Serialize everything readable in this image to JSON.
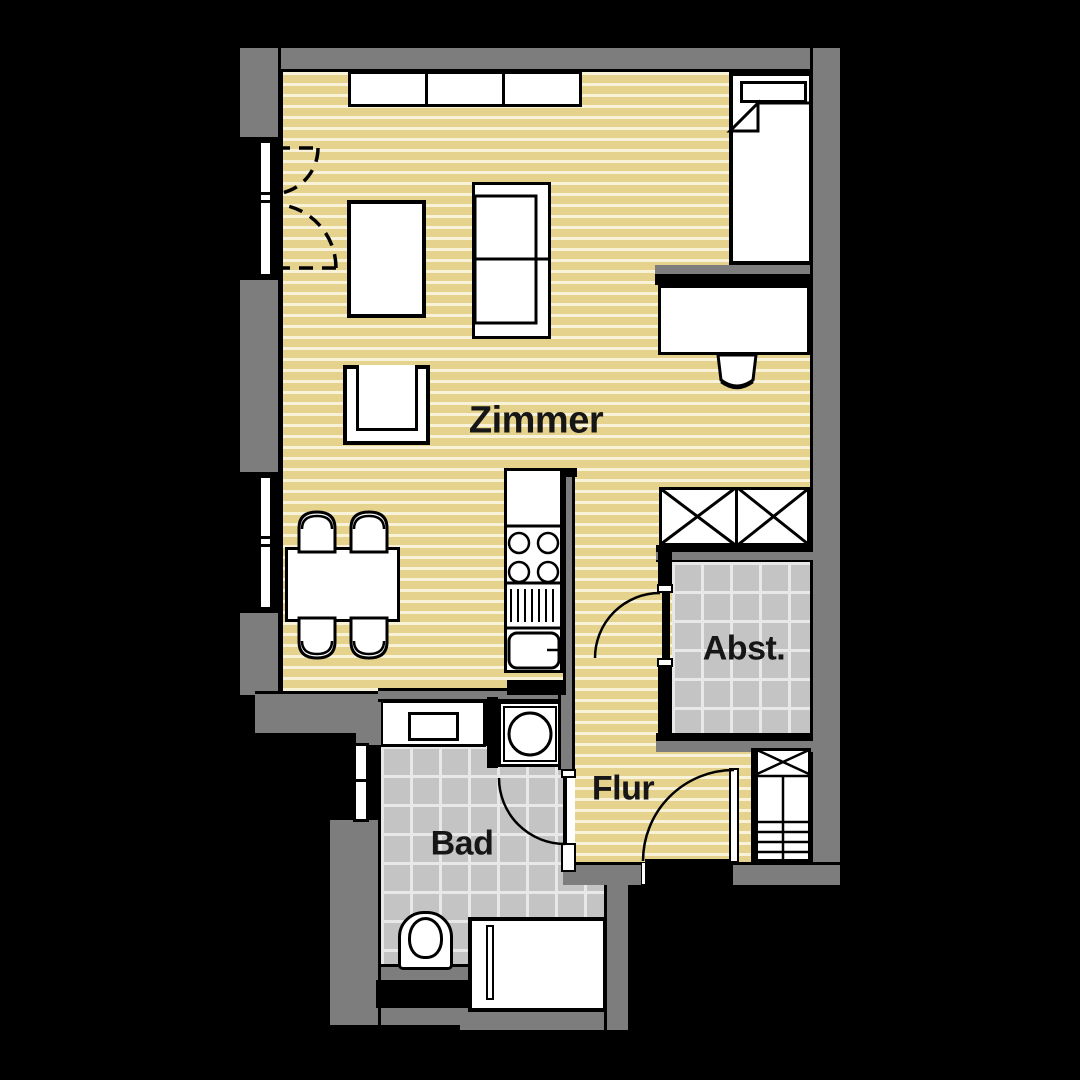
{
  "rooms": {
    "zimmer": {
      "label": "Zimmer"
    },
    "abst": {
      "label": "Abst."
    },
    "flur": {
      "label": "Flur"
    },
    "bad": {
      "label": "Bad"
    }
  },
  "palette": {
    "background": "#000000",
    "wall_gray": "#7d7d7d",
    "wood_floor": "#e5d28d",
    "wood_stripe": "#f8f2d8",
    "tile_gray": "#c4c4c4",
    "tile_line": "#e8e8e8",
    "fixture_white": "#ffffff",
    "outline_black": "#000000",
    "label_text": "#161616"
  }
}
